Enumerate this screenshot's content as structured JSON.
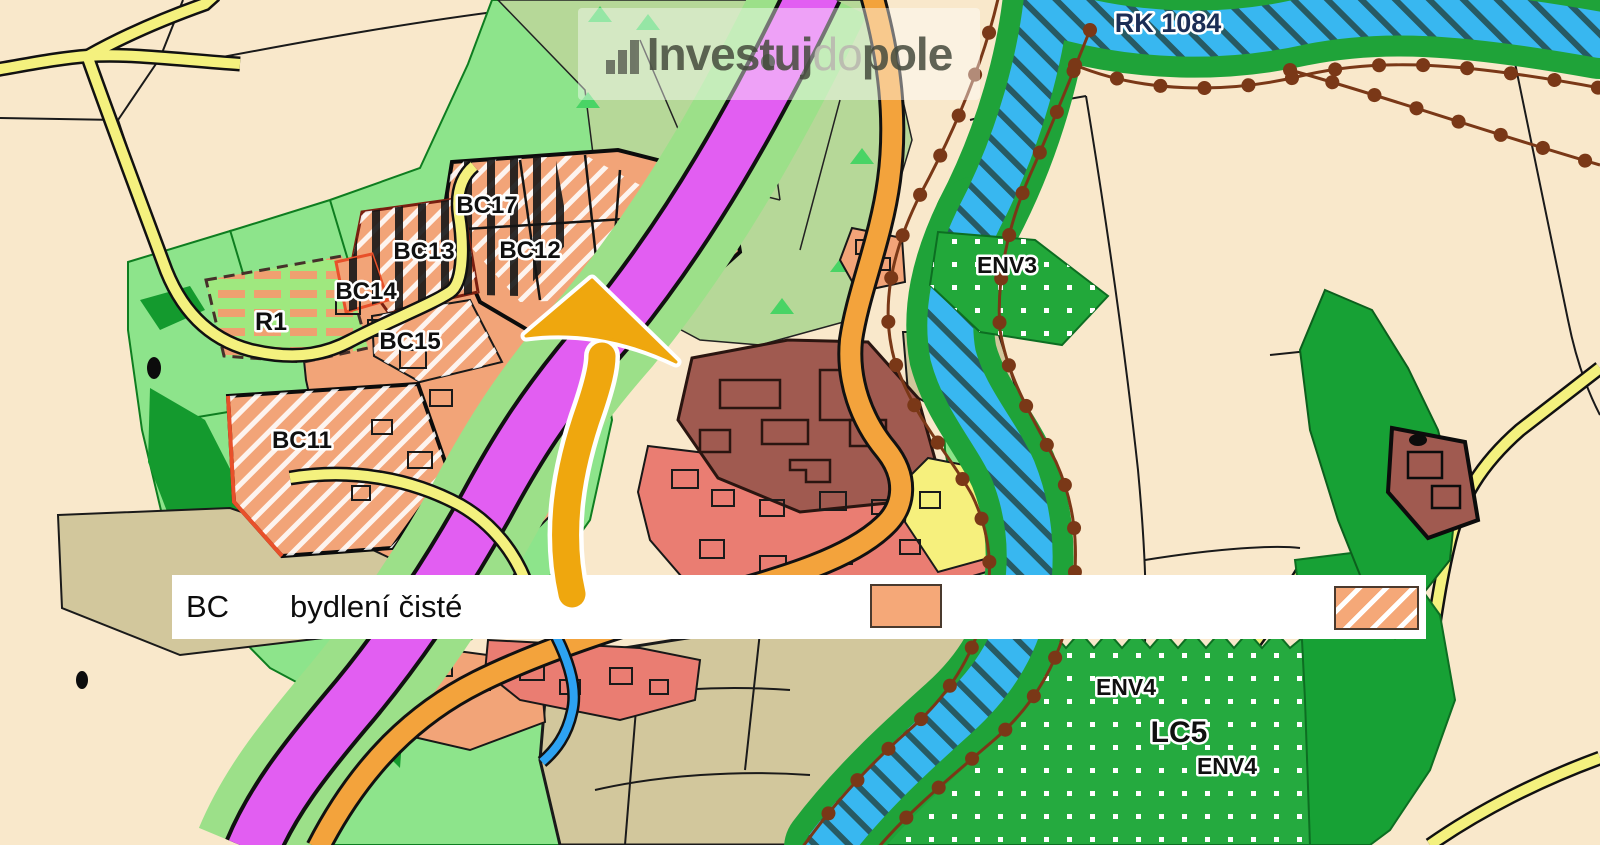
{
  "watermark": {
    "icon": "bar-chart-icon",
    "part1": "Investuj",
    "part2": "do",
    "part3": "pole"
  },
  "map": {
    "labels": {
      "rk1084": "RK 1084",
      "bc17": "BC17",
      "bc13": "BC13",
      "bc12": "BC12",
      "bc14": "BC14",
      "bc15": "BC15",
      "bc11": "BC11",
      "r1": "R1",
      "env3": "ENV3",
      "env4_a": "ENV4",
      "lc5": "LC5",
      "env4_b": "ENV4"
    },
    "colors": {
      "background": "#f9e8cb",
      "field_green": "#8de48b",
      "sage_green": "#b6d898",
      "forest_green": "#17a135",
      "corridor_green": "#1fa339",
      "river_blue": "#38b7f0",
      "road_magenta": "#e25ef2",
      "road_orange": "#f3a33c",
      "road_yellow": "#f4f17e",
      "residential_salmon": "#f2a478",
      "residential_red": "#ea7d72",
      "heritage_brown": "#a05a50",
      "khaki": "#d2c79c",
      "boundary_dot_brown": "#7a3817",
      "arrow_orange": "#efa70e"
    }
  },
  "legend": {
    "code": "BC",
    "label": "bydlení čisté"
  }
}
